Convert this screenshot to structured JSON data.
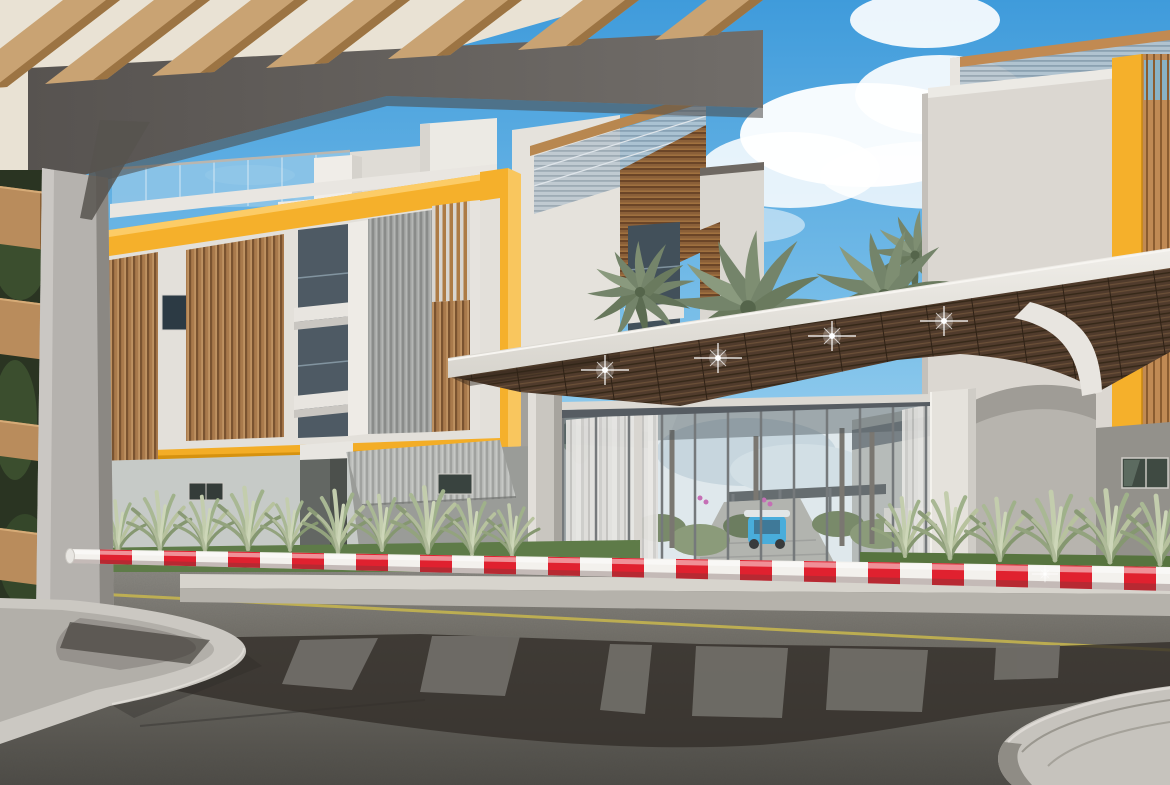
{
  "meta": {
    "title": "Architectural 3D rendering of a gated residential community entrance",
    "type": "exterior-render",
    "width_px": 1170,
    "height_px": 785,
    "no_visible_text": true,
    "visible_text": []
  },
  "palette": {
    "sky_top": "#459fdd",
    "sky_horizon": "#a8d8f0",
    "cloud_white": "#ffffff",
    "accent_yellow": "#f5b02b",
    "accent_yellow_deep": "#e7a11d",
    "wood_light": "#c9a373",
    "wood_dark": "#9c7443",
    "wood_slat": "#a97a4c",
    "soffit_wood": "#503b2c",
    "concrete_light": "#cbc8c2",
    "concrete_shadow": "#8f8c85",
    "wall_white": "#e5e2dc",
    "wall_gray": "#a19f9a",
    "glass_blue": "#8fc6e8",
    "curtain_white": "#e0dfdc",
    "palm_green": "#74846a",
    "shrub_green": "#9fb18a",
    "lawn_green": "#5e7b48",
    "road_gray": "#75736d",
    "shadow_dark": "#34302b",
    "lane_yellow": "#c9b84e",
    "barrier_red": "#e0212f",
    "barrier_white": "#f3f1ed",
    "spotlight_white": "#ffffff"
  },
  "scene": {
    "description": "Daylight render: modern apartment buildings with yellow frame accents and wood-slat screens, glass entrance lobby under an angled canopy with spotlights, palm trees, landscaping, asphalt road with a red-and-white security boom barrier in the foreground, framed by a wooden pergola gate structure.",
    "counts": {
      "canopy_spotlights": 4,
      "palm_tree_clusters": 4,
      "barrier_stripe_colors": [
        "red",
        "white"
      ]
    },
    "objects": [
      {
        "name": "sky",
        "description": "blue gradient sky"
      },
      {
        "name": "clouds",
        "description": "white cumulus clouds, right of center"
      },
      {
        "name": "pergola-beams",
        "description": "light wood beams of entrance gate, top left"
      },
      {
        "name": "gate-header-beam",
        "description": "dark gray header crossing the top"
      },
      {
        "name": "gate-column",
        "description": "gray concrete column, left"
      },
      {
        "name": "wood-slat-fence",
        "description": "stacked wood slats over foliage, far left edge"
      },
      {
        "name": "left-apartment-building",
        "description": "3-story block with yellow frame, wood slat panels, balconies"
      },
      {
        "name": "rooftop-glass-railing",
        "description": "glass balustrade on left building roof"
      },
      {
        "name": "center-building",
        "description": "white volume with roof terrace and balcony recesses"
      },
      {
        "name": "right-building",
        "description": "building with yellow accent band and wood louvers, right edge"
      },
      {
        "name": "palm-trees",
        "description": "palm canopies between buildings"
      },
      {
        "name": "entrance-canopy",
        "description": "angled white canopy with dark wood soffit and 4 spotlights"
      },
      {
        "name": "lobby-glass-wall",
        "description": "full-height glazing with sheer curtains and courtyard view"
      },
      {
        "name": "courtyard-view",
        "description": "path, planting, palm trunks and blue golf cart seen through glass"
      },
      {
        "name": "ornamental-grasses",
        "description": "pale spiky grass clumps along building bases"
      },
      {
        "name": "lawn",
        "description": "green grass strips behind curb"
      },
      {
        "name": "security-barrier",
        "description": "red and white striped boom barrier across the road"
      },
      {
        "name": "road",
        "description": "asphalt with yellow lane line and cast shadows"
      },
      {
        "name": "concrete-islands",
        "description": "rounded concrete curb islands, bottom left and bottom right"
      }
    ]
  }
}
